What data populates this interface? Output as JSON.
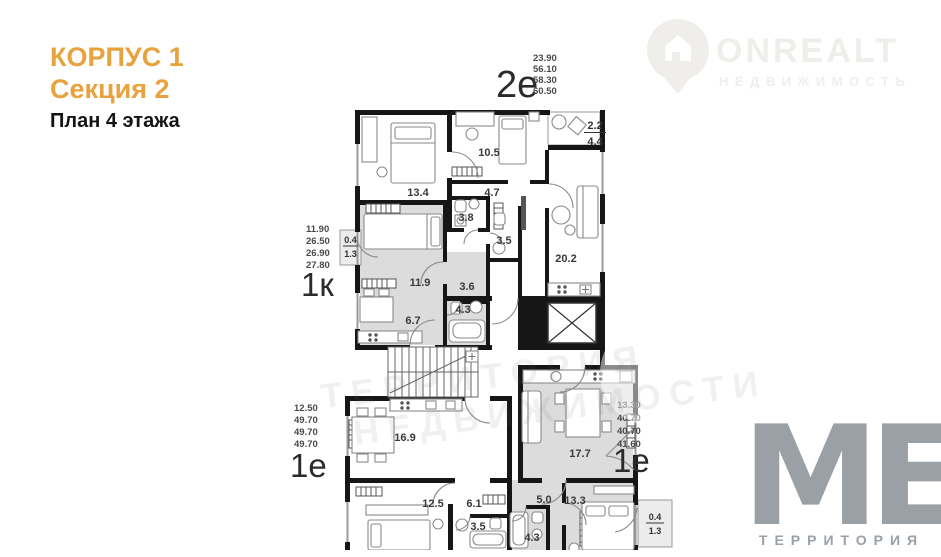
{
  "title_block": {
    "building": "КОРПУС 1",
    "section": "Секция 2",
    "floor": "План 4 этажа"
  },
  "brand": {
    "logo_text": "ONREALT",
    "logo_subtitle": "НЕДВИЖИМОСТЬ"
  },
  "footer_brand": {
    "logo_text": "МЕ.",
    "logo_subtitle": "ТЕРРИТОРИЯ"
  },
  "watermark": {
    "line1": "ТЕРРИТОРИЯ",
    "line2": "НЕДВИЖИМОСТИ"
  },
  "apartments": [
    {
      "id": "apt-2e",
      "type_label": "2е",
      "areas": [
        "23.90",
        "56.10",
        "58.30",
        "60.50"
      ]
    },
    {
      "id": "apt-1k",
      "type_label": "1к",
      "areas": [
        "11.90",
        "26.50",
        "26.90",
        "27.80"
      ]
    },
    {
      "id": "apt-1e-left",
      "type_label": "1е",
      "areas": [
        "12.50",
        "49.70",
        "49.70",
        "49.70"
      ]
    },
    {
      "id": "apt-1e-right",
      "type_label": "1е",
      "areas": [
        "13.30",
        "40.70",
        "40.70",
        "41.60"
      ]
    }
  ],
  "rooms": {
    "r13_4": "13.4",
    "r10_5": "10.5",
    "r4_7": "4.7",
    "r3_8": "3.8",
    "r3_5a": "3.5",
    "r20_2": "20.2",
    "r11_9": "11.9",
    "r3_6": "3.6",
    "r4_3a": "4.3",
    "r6_7": "6.7",
    "r16_9": "16.9",
    "r17_7": "17.7",
    "r12_5": "12.5",
    "r6_1": "6.1",
    "r3_5b": "3.5",
    "r5_0": "5.0",
    "r13_3": "13.3",
    "r4_3b": "4.3"
  },
  "balconies": {
    "top_right": {
      "num": "2.2",
      "den": "4.4"
    },
    "left": {
      "num": "0.4",
      "den": "1.3"
    },
    "bottom_right": {
      "num": "0.4",
      "den": "1.3"
    }
  },
  "colors": {
    "accent": "#e8a23e",
    "wall": "#161616",
    "apartment_shade": "#dcdcdc",
    "brand_gray": "#9aa0a6",
    "watermark_gray": "#efeeea"
  }
}
